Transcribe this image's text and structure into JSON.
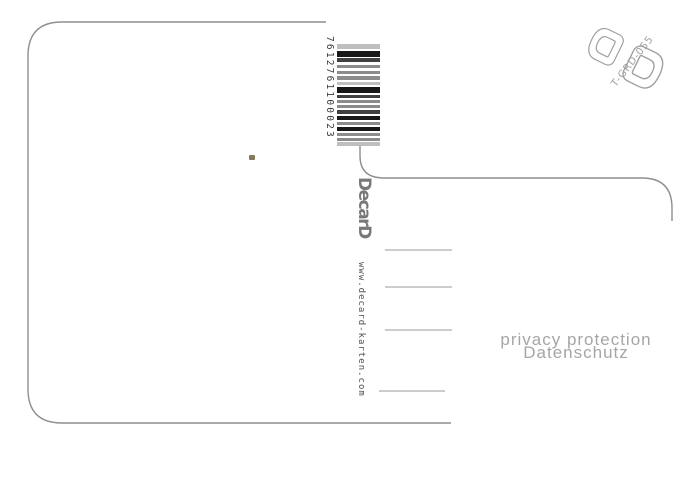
{
  "scan": {
    "barcode": {
      "number": "7612761100023",
      "bars": [
        {
          "h": 5,
          "c": "light"
        },
        {
          "h": 2,
          "c": "gap"
        },
        {
          "h": 6,
          "c": "black"
        },
        {
          "h": 1,
          "c": "gap"
        },
        {
          "h": 4,
          "c": "dark"
        },
        {
          "h": 3,
          "c": "gap"
        },
        {
          "h": 3,
          "c": "mid"
        },
        {
          "h": 3,
          "c": "gap"
        },
        {
          "h": 3,
          "c": "mid"
        },
        {
          "h": 2,
          "c": "gap"
        },
        {
          "h": 4,
          "c": "mid"
        },
        {
          "h": 2,
          "c": "gap"
        },
        {
          "h": 3,
          "c": "light"
        },
        {
          "h": 2,
          "c": "gap"
        },
        {
          "h": 6,
          "c": "black"
        },
        {
          "h": 2,
          "c": "gap"
        },
        {
          "h": 3,
          "c": "dark"
        },
        {
          "h": 2,
          "c": "gap"
        },
        {
          "h": 3,
          "c": "mid"
        },
        {
          "h": 2,
          "c": "gap"
        },
        {
          "h": 3,
          "c": "mid"
        },
        {
          "h": 2,
          "c": "gap"
        },
        {
          "h": 4,
          "c": "dark"
        },
        {
          "h": 2,
          "c": "gap"
        },
        {
          "h": 4,
          "c": "black"
        },
        {
          "h": 2,
          "c": "gap"
        },
        {
          "h": 3,
          "c": "mid"
        },
        {
          "h": 2,
          "c": "gap"
        },
        {
          "h": 4,
          "c": "black"
        },
        {
          "h": 2,
          "c": "gap"
        },
        {
          "h": 3,
          "c": "mid"
        },
        {
          "h": 2,
          "c": "gap"
        },
        {
          "h": 3,
          "c": "mid"
        },
        {
          "h": 1,
          "c": "gap"
        },
        {
          "h": 4,
          "c": "light"
        }
      ]
    },
    "brand": {
      "logo": "DecarD",
      "website": "www.decard-karten.com"
    },
    "stamp_code": "T-GRD-055",
    "privacy_notice": {
      "en": "privacy protection",
      "de": "Datenschutz"
    },
    "colors": {
      "line": "#8e8e8e",
      "rule": "#9a9a9a",
      "digits": "#3a3a3a",
      "logo_grey": "#787878",
      "url_grey": "#4f4f4f",
      "privacy_grey": "#a6a6a6",
      "stamp_grey": "#a0a0a0",
      "speck": "#857a5c",
      "bar_black": "#181818",
      "bar_dark": "#404040",
      "bar_mid": "#8c8c8c",
      "bar_light": "#bfbfbf",
      "bar_gap": "#ffffff"
    }
  }
}
